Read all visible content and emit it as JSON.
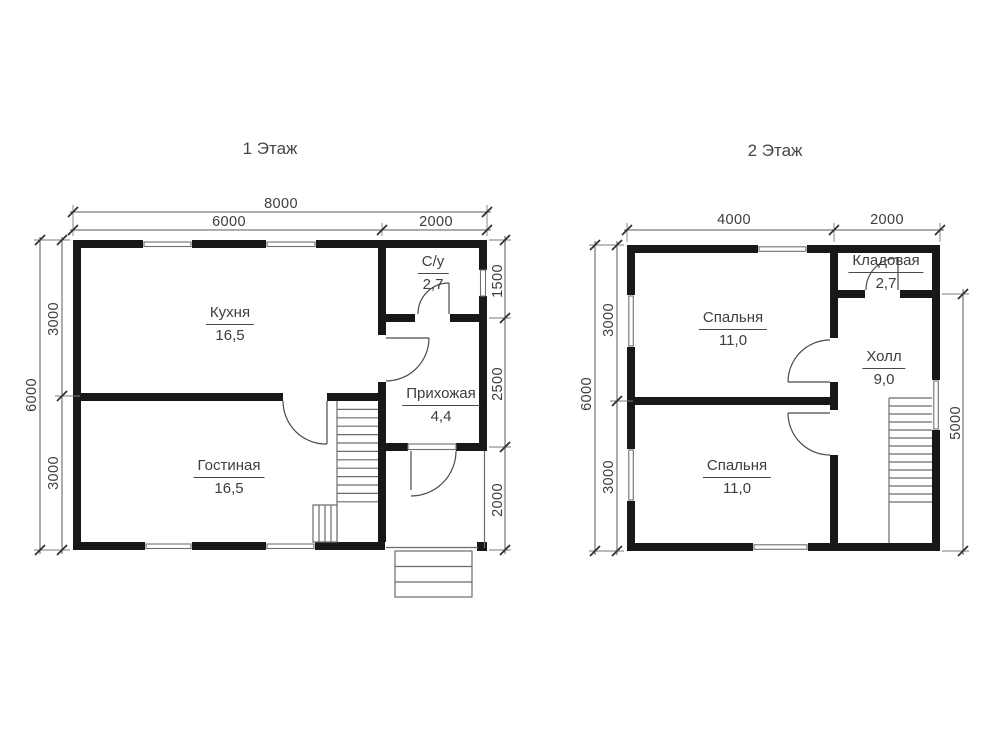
{
  "floor1": {
    "title": "1 Этаж",
    "rooms": [
      {
        "name": "Кухня",
        "area": "16,5"
      },
      {
        "name": "Гостиная",
        "area": "16,5"
      },
      {
        "name": "С/у",
        "area": "2,7"
      },
      {
        "name": "Прихожая",
        "area": "4,4"
      }
    ],
    "dims": {
      "total_width": "8000",
      "width_main": "6000",
      "width_right": "2000",
      "total_height": "6000",
      "height_top": "3000",
      "height_bottom": "3000",
      "right_top": "1500",
      "right_mid": "2500",
      "right_bottom": "2000"
    }
  },
  "floor2": {
    "title": "2 Этаж",
    "rooms": [
      {
        "name": "Спальня",
        "area": "11,0"
      },
      {
        "name": "Спальня",
        "area": "11,0"
      },
      {
        "name": "Кладовая",
        "area": "2,7"
      },
      {
        "name": "Холл",
        "area": "9,0"
      }
    ],
    "dims": {
      "width_main": "4000",
      "width_right": "2000",
      "total_height": "6000",
      "height_top": "3000",
      "height_bottom": "3000",
      "right_height": "5000"
    }
  },
  "colors": {
    "wall": "#181818",
    "line": "#6b6b6b",
    "text": "#3d3d3d"
  }
}
